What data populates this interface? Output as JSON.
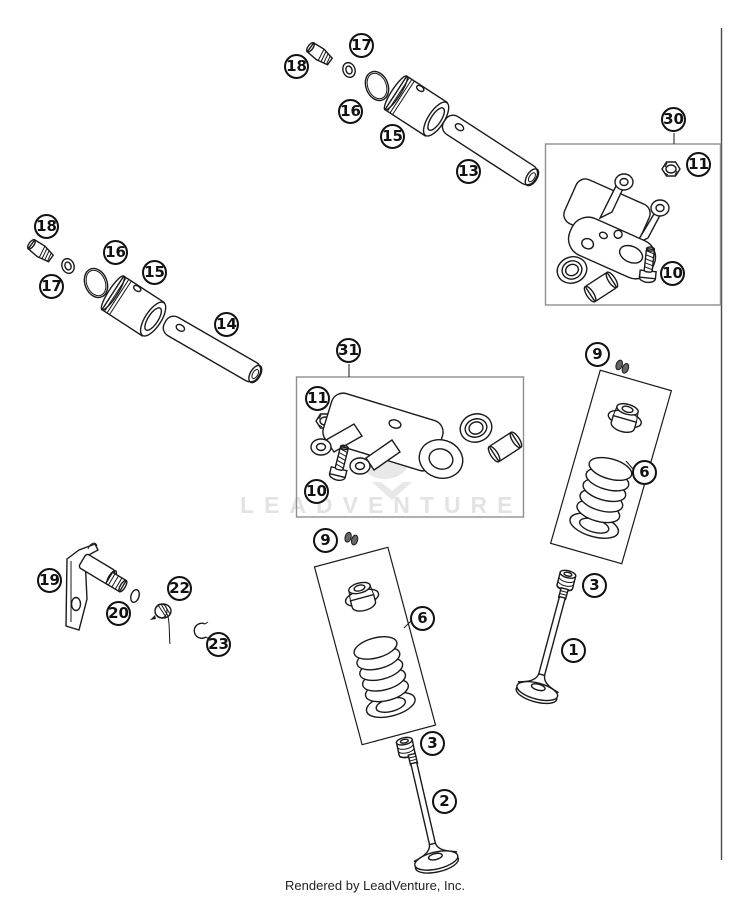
{
  "colors": {
    "line": "#1a1a1a",
    "group_box_border": "#8f8f8f",
    "watermark": "#e3e3e3",
    "keeper_fill": "#666666",
    "background": "#ffffff"
  },
  "watermark": "LEADVENTURE",
  "caption": "Rendered by LeadVenture, Inc.",
  "callouts": {
    "c13": "13",
    "c14": "14",
    "c15a": "15",
    "c15b": "15",
    "c16a": "16",
    "c16b": "16",
    "c17a": "17",
    "c17b": "17",
    "c18a": "18",
    "c18b": "18",
    "c30": "30",
    "c31": "31",
    "c11a": "11",
    "c11b": "11",
    "c10a": "10",
    "c10b": "10",
    "c9a": "9",
    "c9b": "9",
    "c6a": "6",
    "c6b": "6",
    "c3a": "3",
    "c3b": "3",
    "c1": "1",
    "c2": "2",
    "c19": "19",
    "c20": "20",
    "c22": "22",
    "c23": "23"
  }
}
